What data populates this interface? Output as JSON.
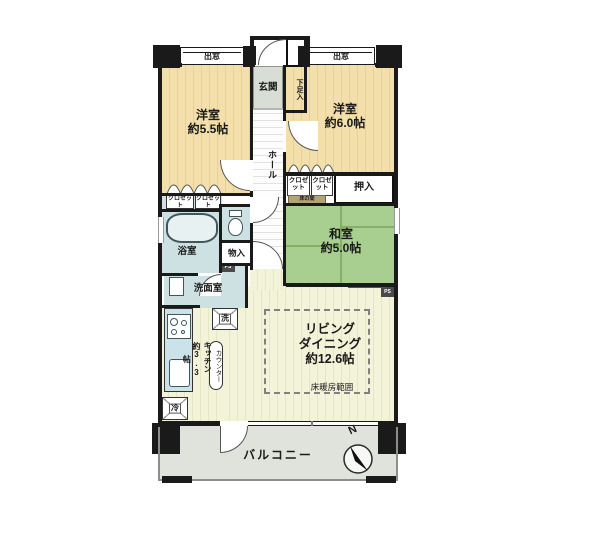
{
  "rooms": {
    "west1": {
      "name": "洋室",
      "size": "約5.5帖"
    },
    "west2": {
      "name": "洋室",
      "size": "約6.0帖"
    },
    "japanese": {
      "name": "和室",
      "size": "約5.0帖"
    },
    "living": {
      "name_line1": "リビング",
      "name_line2": "ダイニング",
      "size": "約12.6帖"
    },
    "kitchen": {
      "name": "キッチン",
      "size": "約3.3帖"
    },
    "bath": {
      "name": "浴室"
    },
    "washroom": {
      "name": "洗面室"
    },
    "entrance": {
      "name": "玄関"
    },
    "hall": {
      "name": "ホール"
    },
    "balcony": {
      "name": "バルコニー"
    }
  },
  "fixtures": {
    "bay_window": "出窓",
    "meter_box": "MB",
    "shoe_cabinet": "下足入",
    "closet": "クロゼット",
    "oshiire": "押入",
    "tokonoma": "床の間",
    "storage": "物入",
    "pipe_space": "PS",
    "washer": "洗",
    "fridge": "冷",
    "counter": "カウンター",
    "floor_heating": "床暖房範囲",
    "north": "N"
  },
  "colors": {
    "wall": "#1a1a1a",
    "western_room": "#f3dfab",
    "tatami": "#a9cf90",
    "living": "#f3f3da",
    "water_area": "#cde1e2",
    "kitchen_counter": "#cbe2e9",
    "entrance": "#d8ddd6",
    "balcony": "#dfe3dc",
    "tokonoma": "#b2a476"
  }
}
